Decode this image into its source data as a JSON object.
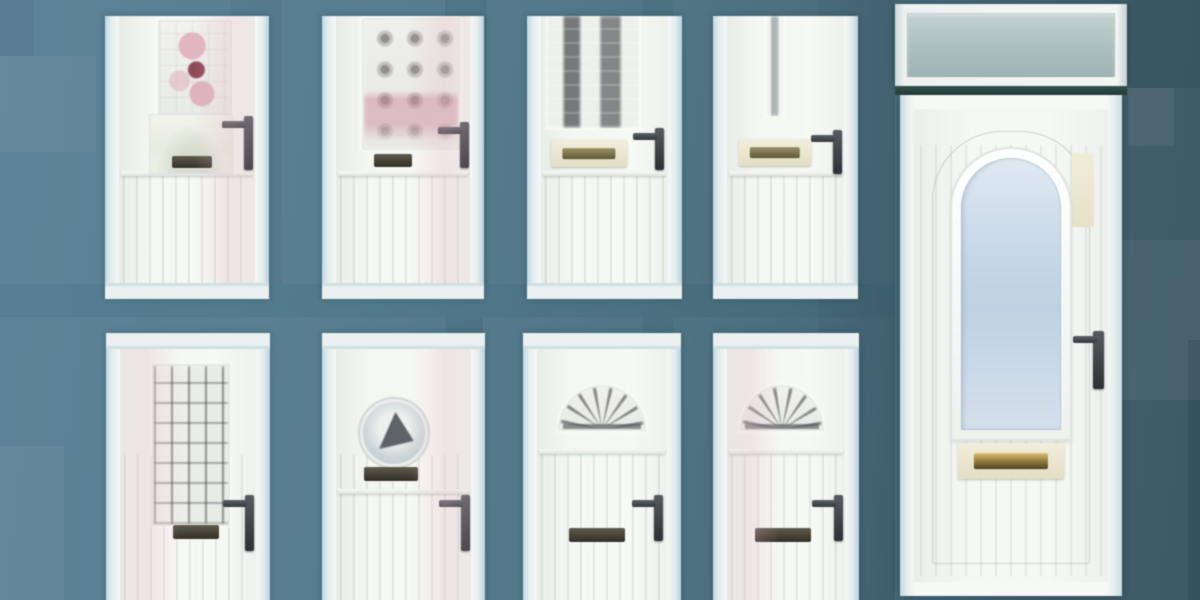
{
  "scene": {
    "description": "Product collage of nine white uPVC front doors displayed on a teal patchwork background",
    "grid": {
      "rows": 2,
      "columns": 4
    },
    "panel_count": 9
  },
  "colors": {
    "background_left": "#5D8398",
    "background_middle": "#4E7480",
    "background_right": "#3E5966",
    "door_white": "#F6F9F7",
    "frame_blue_tint": "#C9DEE8",
    "transom_glass": "#AABFBE",
    "transom_bar": "#2E4A46",
    "arch_glass_blue": "#C6D7E7",
    "letterbox_brass": "#C2A64E",
    "letterplate_cream": "#EDE9C9",
    "letterbox_dark": "#4A473D",
    "handle_dark": "#3A3F45",
    "stained_glass_pink": "#E2AFBE",
    "stained_glass_red": "#8E3A4B",
    "leaded_glass_dark": "#3C3F44"
  },
  "doors": [
    {
      "id": 1,
      "position": "row 1, column 1",
      "label": "White uPVC door with pink floral stained-glass panel, lower glazed light and dark lever handle"
    },
    {
      "id": 2,
      "position": "row 1, column 2",
      "label": "White uPVC door with square bullseye-rondel glazed panel and dark letterbox"
    },
    {
      "id": 3,
      "position": "row 1, column 3",
      "label": "White uPVC door with twin vertical leaded glass strips and cream letterplate"
    },
    {
      "id": 4,
      "position": "row 1, column 4",
      "label": "White uPVC cottage door with slim vertical glazing strip and cream letterplate"
    },
    {
      "id": 5,
      "position": "row 2, column 1",
      "label": "White uPVC door with tall rectangular leaded-grid glass panel and dark letterbox"
    },
    {
      "id": 6,
      "position": "row 2, column 2",
      "label": "White uPVC door with round porthole window with ship motif and dark letterbox"
    },
    {
      "id": 7,
      "position": "row 2, column 3",
      "label": "White uPVC cottage door with fan-shaped sunburst glazing and dark letterbox"
    },
    {
      "id": 8,
      "position": "row 2, column 4",
      "label": "White uPVC cottage door with fan-shaped sunburst glazing and dark letterbox"
    }
  ],
  "large_door": {
    "label": "Large white uPVC entrance door with arched blue glazed panel, brass letterplate, dark lever handle and glazed transom top light",
    "features": [
      "glazed transom top light",
      "dark transom divider bar",
      "arch-top frosted blue window",
      "brass letterbox on cream plate",
      "dark lever handle",
      "cream hinge strip"
    ]
  }
}
